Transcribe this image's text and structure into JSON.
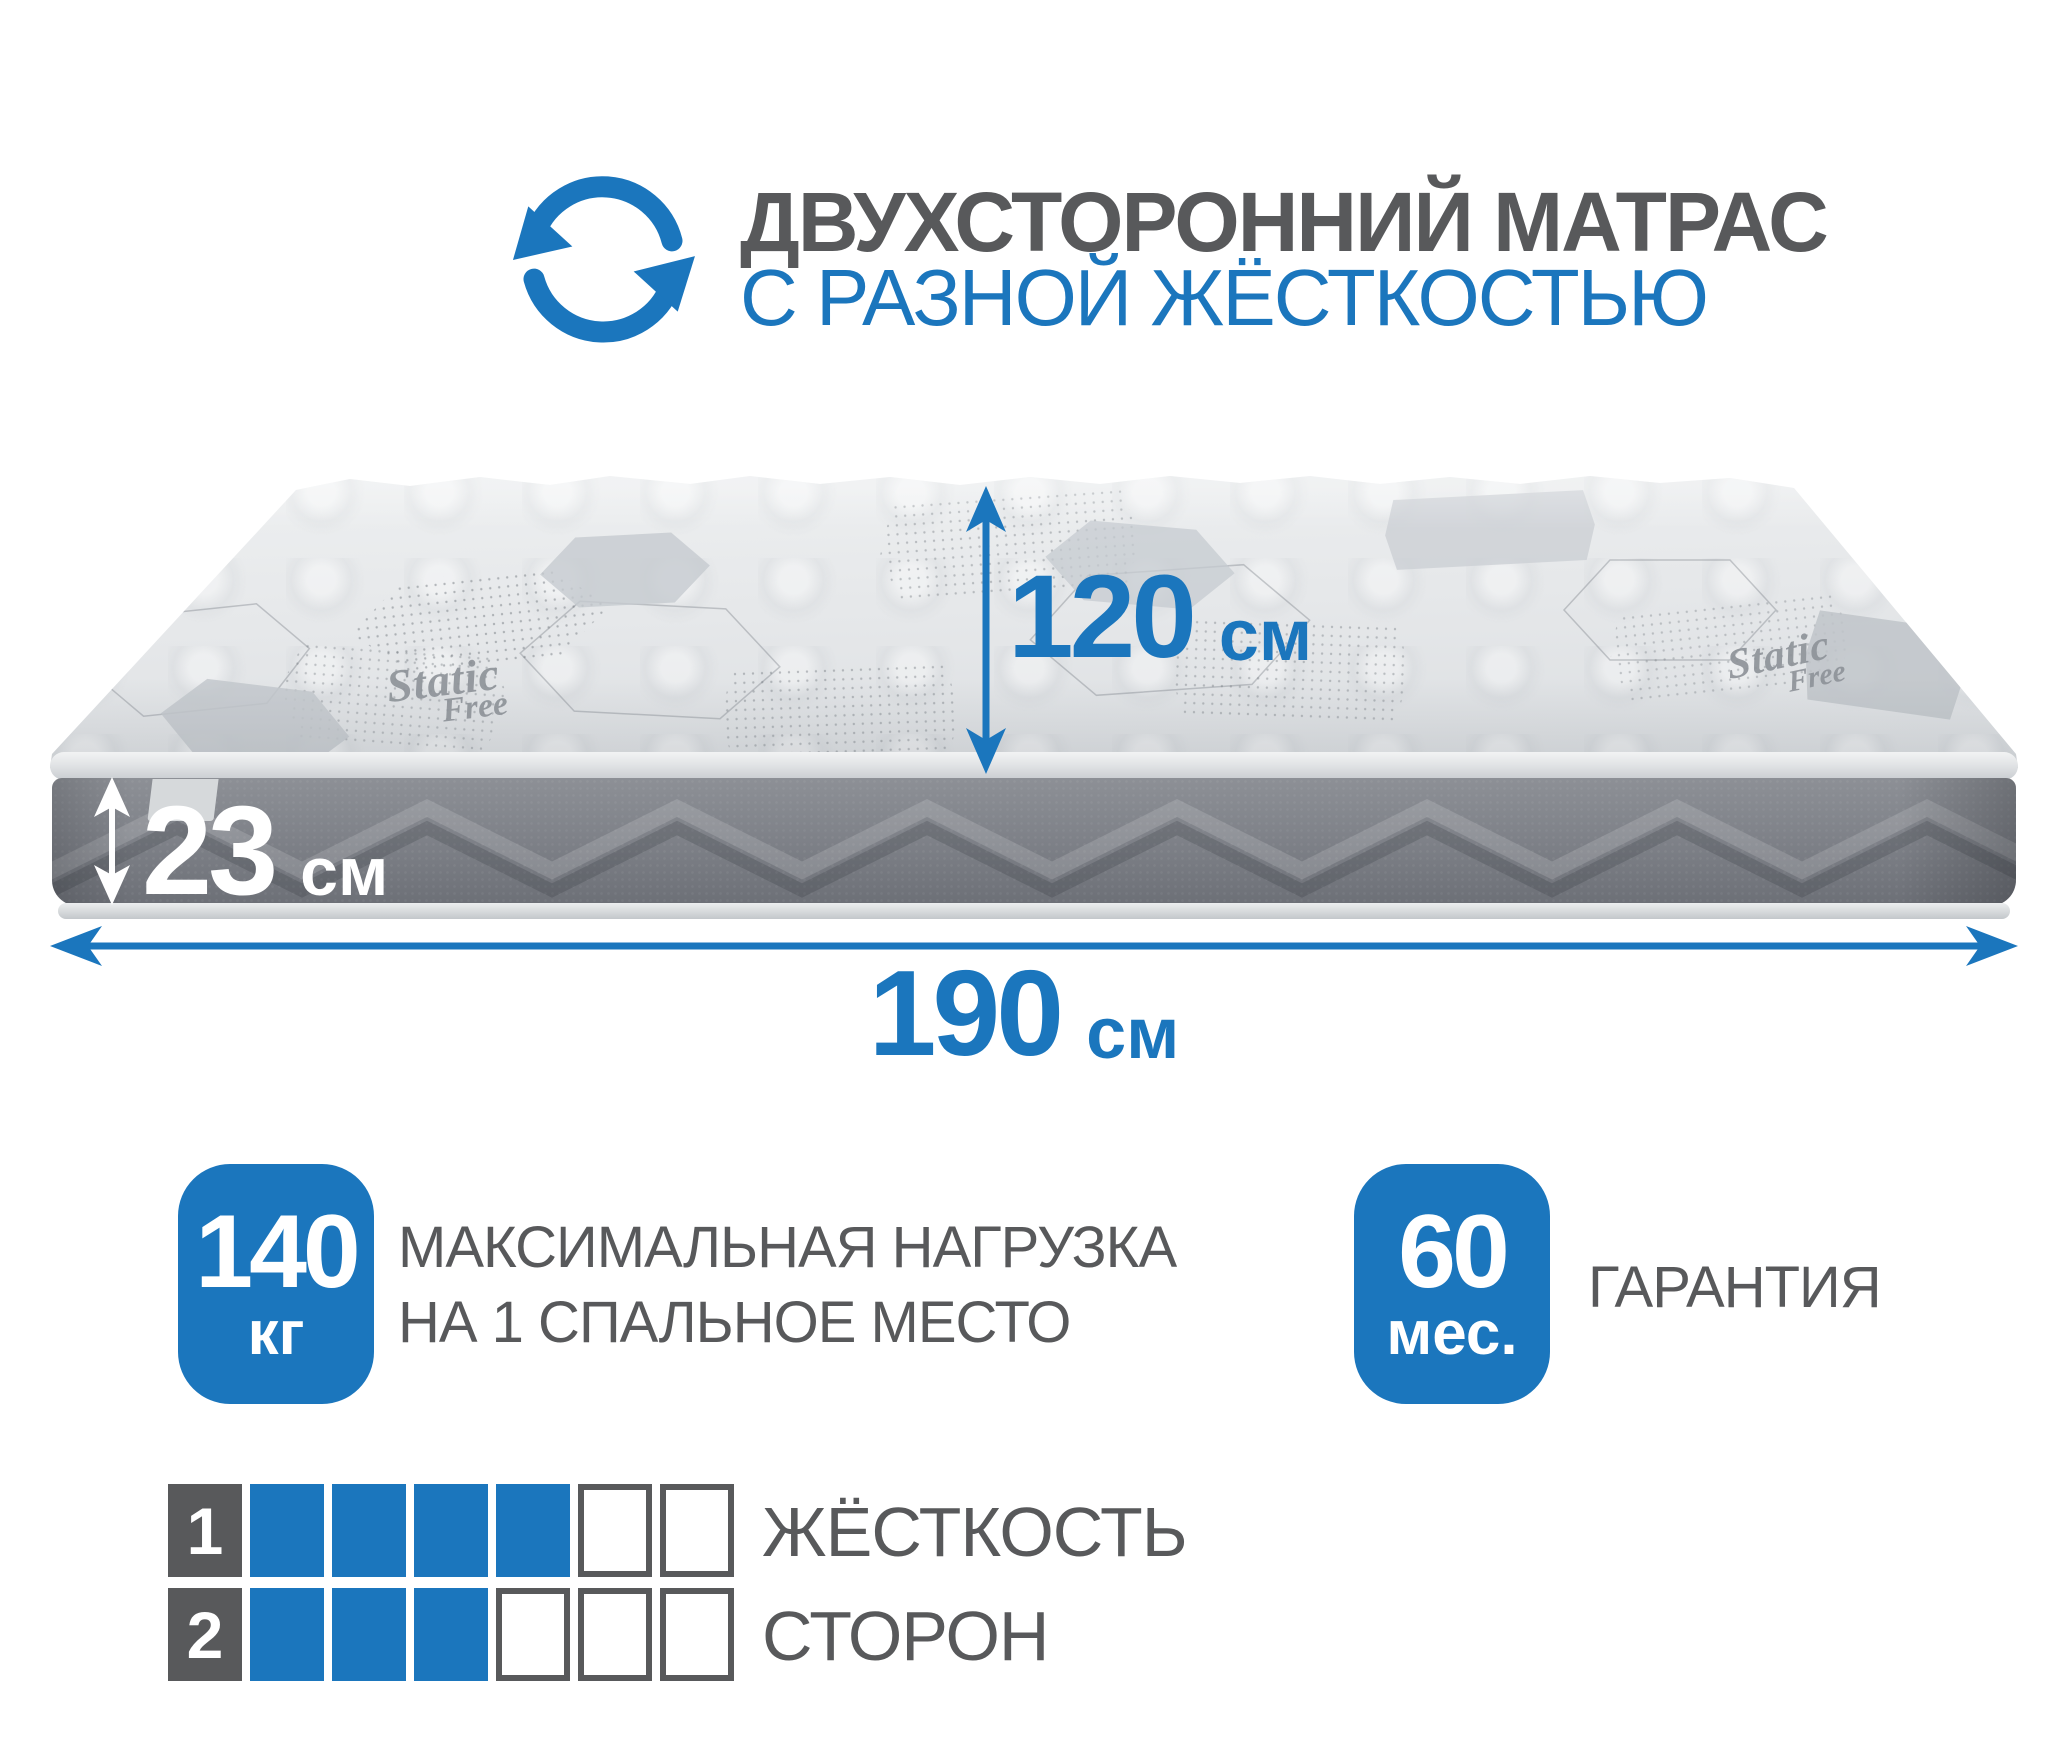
{
  "header": {
    "title": "ДВУХСТОРОННИЙ МАТРАС",
    "subtitle": "С РАЗНОЙ ЖЁСТКОСТЬЮ"
  },
  "mattress": {
    "fabric_logo": {
      "line1": "Static",
      "line2": "Free"
    },
    "dimensions": {
      "depth": {
        "value": "120",
        "unit": "см"
      },
      "height": {
        "value": "23",
        "unit": "см"
      },
      "length": {
        "value": "190",
        "unit": "см"
      }
    }
  },
  "stats": {
    "max_load": {
      "value": "140",
      "unit": "кг",
      "label_line1": "МАКСИМАЛЬНАЯ НАГРУЗКА",
      "label_line2": "НА 1 СПАЛЬНОЕ МЕСТО"
    },
    "warranty": {
      "value": "60",
      "unit": "мес.",
      "label": "ГАРАНТИЯ"
    }
  },
  "firmness": {
    "label_line1": "ЖЁСТКОСТЬ",
    "label_line2": "СТОРОН",
    "scale_max": 6,
    "rows": [
      {
        "side": "1",
        "filled": 4
      },
      {
        "side": "2",
        "filled": 3
      }
    ]
  },
  "colors": {
    "accent_blue": "#1b76bd",
    "text_gray": "#58595b"
  }
}
